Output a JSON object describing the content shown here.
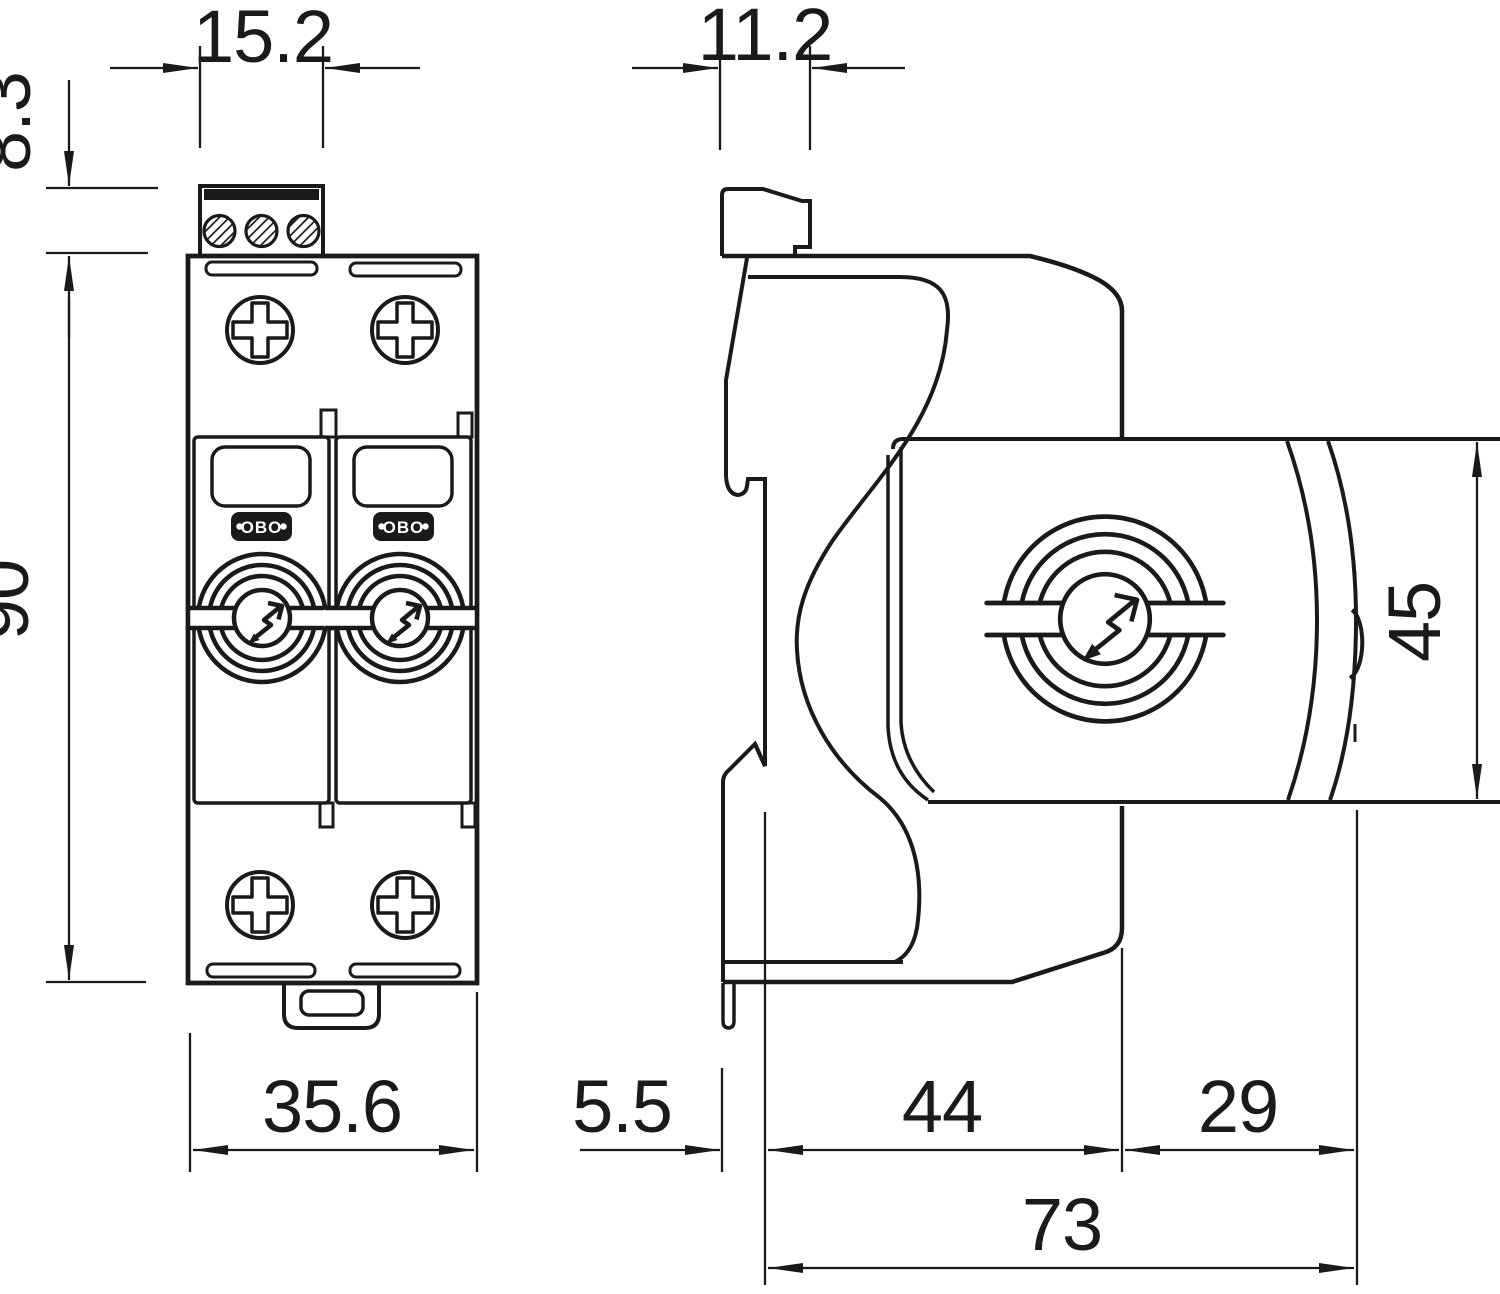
{
  "drawing": {
    "logo_text": "OBO",
    "dimensions": {
      "front_terminal_width": "15.2",
      "front_terminal_height": "8.3",
      "front_body_height": "90",
      "front_body_width": "35.6",
      "side_terminal_width": "11.2",
      "side_module_height": "45",
      "side_rail_recess_depth": "5.5",
      "side_base_depth": "44",
      "side_module_overhang": "29",
      "side_total_depth": "73"
    },
    "colors": {
      "line": "#1a1a1a",
      "background": "#ffffff"
    },
    "symbols": [
      "surge-arrester-lightning-icon",
      "phillips-screw-icon",
      "terminal-screw-icon"
    ]
  }
}
